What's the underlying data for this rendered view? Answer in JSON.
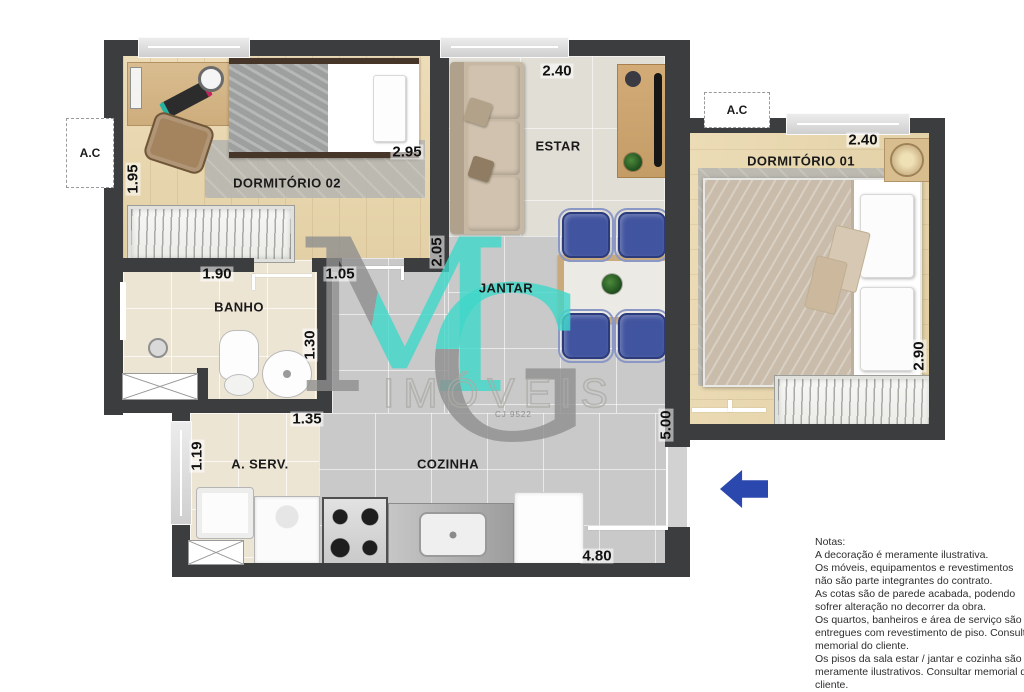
{
  "plan": {
    "room_labels": {
      "dormitorio02": "DORMITÓRIO 02",
      "estar": "ESTAR",
      "jantar": "JANTAR",
      "dormitorio01": "DORMITÓRIO 01",
      "banho": "BANHO",
      "area_servico": "A. SERV.",
      "cozinha": "COZINHA"
    },
    "ac_left": "A.C",
    "ac_right": "A.C",
    "dimensions": {
      "dorm02_left": "1.95",
      "dorm02_right": "2.95",
      "banho_width": "1.90",
      "hall_door": "1.05",
      "banho_depth": "1.30",
      "aserv_width": "1.35",
      "aserv_depth": "1.19",
      "estar_width": "2.40",
      "estar_depth": "2.05",
      "cozinha_width": "4.80",
      "cozinha_depth": "5.00",
      "dorm01_width": "2.40",
      "dorm01_depth": "2.90"
    },
    "colors": {
      "accent_blue": "#2b48ae",
      "wall": "#3c3d3f",
      "watermark_cyan": "#3fd8ca",
      "watermark_gray": "#8f8f8f"
    }
  },
  "watermark": {
    "letter_m": "M",
    "letter_g": "G",
    "name": "IMÓVEIS",
    "registry": "CJ 9522"
  },
  "notes": {
    "title": "Notas:",
    "lines": [
      "A decoração é meramente ilustrativa.",
      "Os móveis, equipamentos e revestimentos",
      "não são parte integrantes do contrato.",
      "As cotas são de parede acabada, podendo",
      "sofrer alteração no decorrer da obra.",
      "Os quartos, banheiros e área de serviço são",
      "entregues com revestimento de piso. Consultar",
      "memorial do cliente.",
      "Os pisos da sala estar / jantar e cozinha são",
      "meramente ilustrativos. Consultar memorial do",
      "cliente."
    ]
  }
}
